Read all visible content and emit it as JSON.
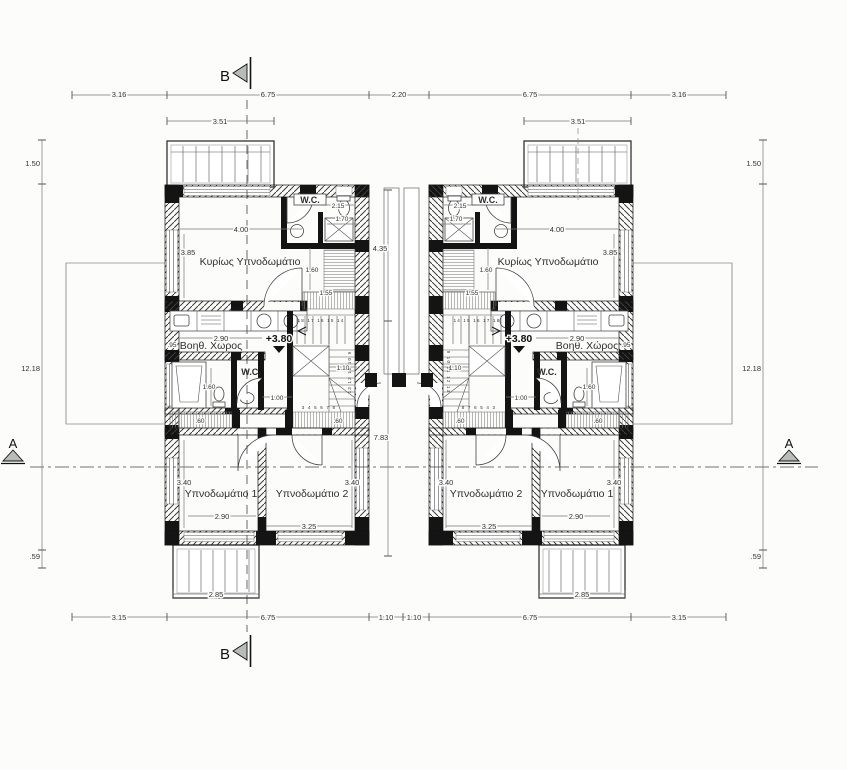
{
  "plan": {
    "sections": {
      "a": "A",
      "b": "B"
    },
    "level": "+3.80",
    "rooms": {
      "master": "Κυρίως Υπνοδωμάτιο",
      "wc": "W.C.",
      "aux": "Βοηθ. Χώρος",
      "bed1": "Υπνοδωμάτιο 1",
      "bed2": "Υπνοδωμάτιο 2"
    },
    "dims": {
      "top": [
        "3.16",
        "6.75",
        "2.20",
        "6.75",
        "3.16"
      ],
      "bottom": [
        "3.15",
        "6.75",
        "1.10",
        "1.10",
        "6.75",
        "3.15"
      ],
      "side": [
        "1.50",
        "12.18",
        ".59"
      ],
      "balcony_top": "3.51",
      "balcony_bottom": "2.85",
      "mid_upper": "4.35",
      "mid_lower": "7.83",
      "room_w": "4.00",
      "room_h": "3.85",
      "wc_w": "2.15",
      "shower_w": "1.70",
      "stair_v": "1.60",
      "stair_h": "1.55",
      "kitchen_w": "2.90",
      "aux_h": ".95",
      "bath_h": "1.60",
      "hall_w": "1.00",
      "stair_w": "1.10",
      "ledge": ".60",
      "bed_h": "3.40",
      "bed1_w": "2.90",
      "bed2_w": "3.25"
    },
    "stairs": {
      "left_top": "18 17 16 15 14",
      "left_side": "13 12 11 10 9",
      "left_bottom": "3 4 5 6 7 8",
      "right_top": "14 15 16 17 18",
      "right_side": "9 10 11 12 13",
      "right_bottom": "8 7 6 5 4 3"
    }
  }
}
